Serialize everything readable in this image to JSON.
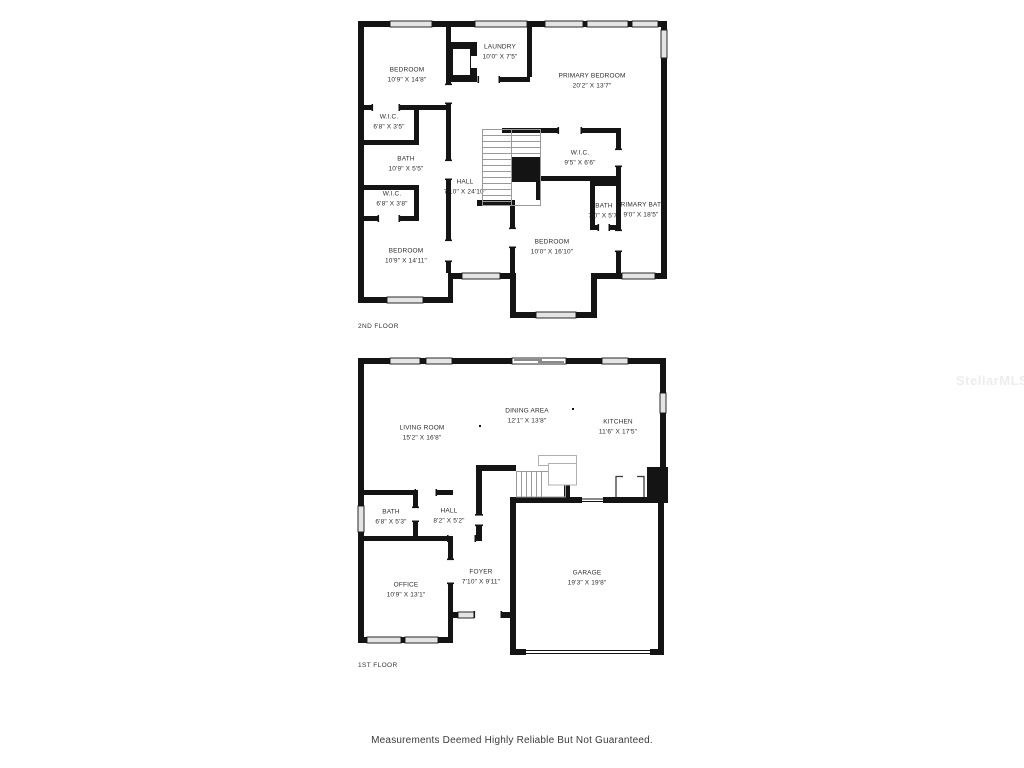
{
  "watermark": "StellarMLS",
  "footer": {
    "disclaimer": "Measurements Deemed Highly Reliable But Not Guaranteed."
  },
  "colors": {
    "wall": "#141414",
    "window_fill": "#e4e4e4",
    "stair_line": "#9a9a9a",
    "landing_line": "#b0b0b0",
    "label_text": "#2d2d2d",
    "watermark_text": "#ededed"
  },
  "second_floor": {
    "title": "2ND FLOOR",
    "rooms": {
      "bedroom_top_left": {
        "name": "BEDROOM",
        "dims": "10'9\" X 14'8\""
      },
      "laundry": {
        "name": "LAUNDRY",
        "dims": "10'0\" X 7'5\""
      },
      "primary_bedroom": {
        "name": "PRIMARY BEDROOM",
        "dims": "20'2\" X 13'7\""
      },
      "wic_left_upper": {
        "name": "W.I.C.",
        "dims": "6'8\" X 3'5\""
      },
      "bath_left": {
        "name": "BATH",
        "dims": "10'9\" X 5'5\""
      },
      "hall": {
        "name": "HALL",
        "dims": "7'10\" X 24'10\""
      },
      "wic_primary": {
        "name": "W.I.C.",
        "dims": "9'5\" X 6'6\""
      },
      "wic_left_lower": {
        "name": "W.I.C.",
        "dims": "6'8\" X 3'8\""
      },
      "bath_center": {
        "name": "BATH",
        "dims": "7'0\" X 5'7\""
      },
      "primary_bath": {
        "name": "PRIMARY BATH",
        "dims": "9'0\" X 18'5\""
      },
      "bedroom_bottom_left": {
        "name": "BEDROOM",
        "dims": "10'9\" X 14'11\""
      },
      "bedroom_bottom_center": {
        "name": "BEDROOM",
        "dims": "10'0\" X 16'10\""
      }
    }
  },
  "first_floor": {
    "title": "1ST FLOOR",
    "rooms": {
      "living_room": {
        "name": "LIVING ROOM",
        "dims": "15'2\" X 16'8\""
      },
      "dining_area": {
        "name": "DINING AREA",
        "dims": "12'1\" X 13'8\""
      },
      "kitchen": {
        "name": "KITCHEN",
        "dims": "11'6\" X 17'5\""
      },
      "bath": {
        "name": "BATH",
        "dims": "6'8\" X 5'3\""
      },
      "hall": {
        "name": "HALL",
        "dims": "8'2\" X 5'2\""
      },
      "office": {
        "name": "OFFICE",
        "dims": "10'9\" X 13'1\""
      },
      "foyer": {
        "name": "FOYER",
        "dims": "7'10\" X 9'11\""
      },
      "garage": {
        "name": "GARAGE",
        "dims": "19'3\" X 19'8\""
      }
    }
  }
}
